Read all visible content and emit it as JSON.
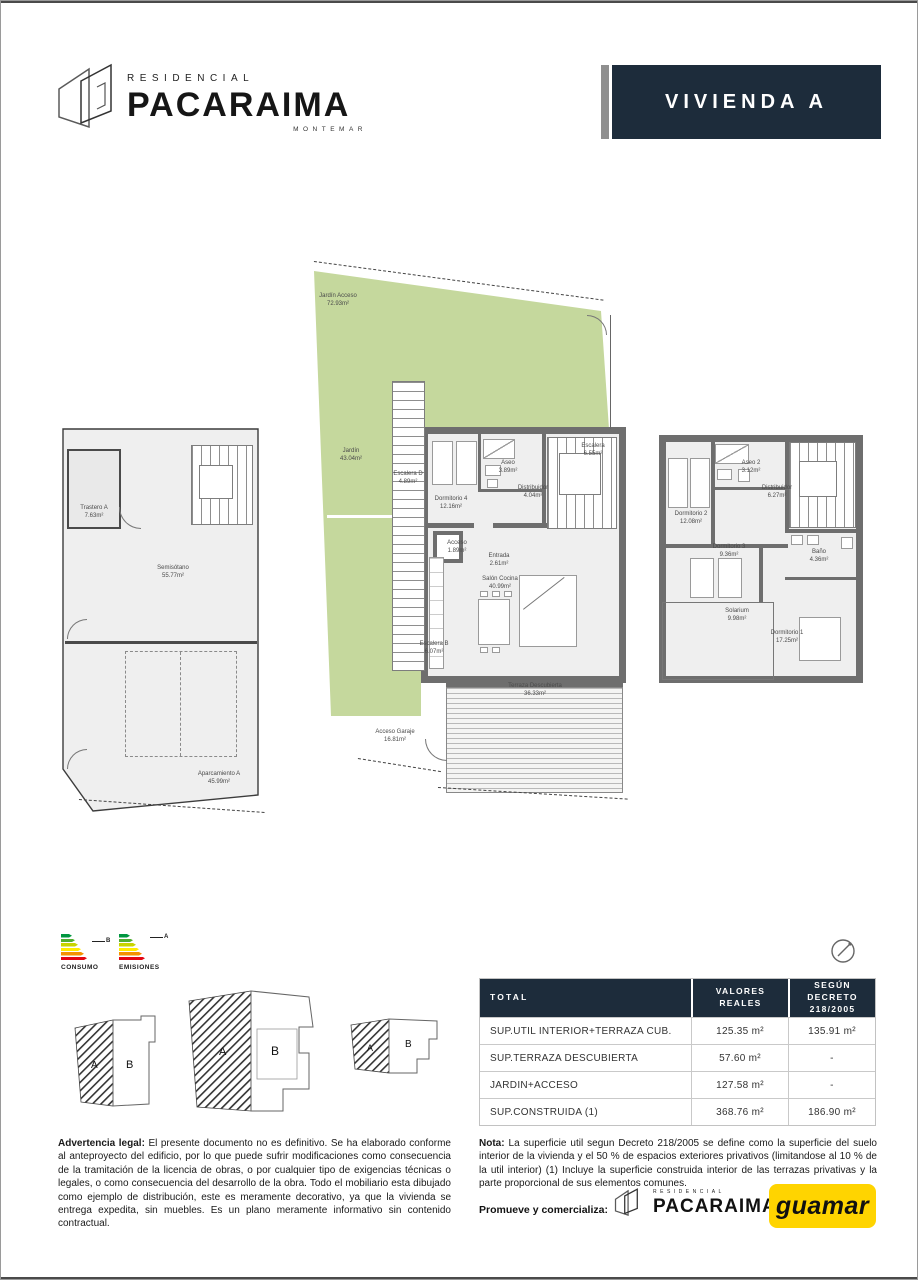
{
  "header": {
    "brand_top": "RESIDENCIAL",
    "brand_name": "PACARAIMA",
    "brand_sub": "MONTEMAR",
    "unit_title": "VIVIENDA A"
  },
  "plans": {
    "basement": {
      "rooms": [
        {
          "n": "Trastero A",
          "a": "7.63m²"
        },
        {
          "n": "Semisótano",
          "a": "55.77m²"
        },
        {
          "n": "Aparcamiento A",
          "a": "45.99m²"
        }
      ]
    },
    "ground": {
      "rooms": [
        {
          "n": "Jardín Acceso",
          "a": "72.93m²"
        },
        {
          "n": "Jardín",
          "a": "43.04m²"
        },
        {
          "n": "Escalera D",
          "a": "4.89m²"
        },
        {
          "n": "Dormitorio 4",
          "a": "12.16m²"
        },
        {
          "n": "Aseo",
          "a": "3.89m²"
        },
        {
          "n": "Distribuidor",
          "a": "4.04m²"
        },
        {
          "n": "Escalera",
          "a": "6.55m²"
        },
        {
          "n": "Acceso",
          "a": "1.89m²"
        },
        {
          "n": "Entrada",
          "a": "2.61m²"
        },
        {
          "n": "Salón Cocina",
          "a": "40.99m²"
        },
        {
          "n": "Escalera B",
          "a": "6.07m²"
        },
        {
          "n": "Terraza Descubierta",
          "a": "36.33m²"
        },
        {
          "n": "Acceso Garaje",
          "a": "16.81m²"
        }
      ]
    },
    "upper": {
      "rooms": [
        {
          "n": "Dormitorio 2",
          "a": "12.08m²"
        },
        {
          "n": "Aseo 2",
          "a": "3.12m²"
        },
        {
          "n": "Distribuidor",
          "a": "6.27m²"
        },
        {
          "n": "Baño",
          "a": "4.36m²"
        },
        {
          "n": "Dormitorio 3",
          "a": "9.36m²"
        },
        {
          "n": "Solarium",
          "a": "9.98m²"
        },
        {
          "n": "Dormitorio 1",
          "a": "17.25m²"
        }
      ]
    }
  },
  "energy": {
    "consumo_label": "CONSUMO",
    "consumo_rating": "B",
    "emisiones_label": "EMISIONES",
    "emisiones_rating": "A"
  },
  "keyplan": {
    "zone_a": "A",
    "zone_b": "B"
  },
  "table": {
    "headers": [
      "TOTAL",
      "VALORES REALES",
      "SEGÚN DECRETO 218/2005"
    ],
    "rows": [
      {
        "label": "SUP.UTIL INTERIOR+TERRAZA CUB.",
        "real": "125.35 m²",
        "decreto": "135.91 m²"
      },
      {
        "label": "SUP.TERRAZA DESCUBIERTA",
        "real": "57.60 m²",
        "decreto": "-"
      },
      {
        "label": "JARDIN+ACCESO",
        "real": "127.58 m²",
        "decreto": "-"
      },
      {
        "label": "SUP.CONSTRUIDA (1)",
        "real": "368.76 m²",
        "decreto": "186.90 m²"
      }
    ]
  },
  "legal": {
    "lead": "Advertencia legal:",
    "body": " El presente documento no es definitivo. Se ha elaborado conforme al anteproyecto del edificio, por lo que puede sufrir modificaciones como consecuencia de la tramitación de la licencia de obras, o por cualquier tipo de exigencias técnicas o legales, o como consecuencia del desarrollo de la obra. Todo el mobiliario esta dibujado como ejemplo de distribución, este es meramente decorativo, ya que la vivienda se entrega expedita, sin muebles. Es un plano meramente informativo sin contenido contractual."
  },
  "nota": {
    "lead": "Nota:",
    "body": " La superficie util segun Decreto 218/2005 se define como la superficie del suelo interior de la vivienda y el 50 % de espacios exteriores privativos (limitandose al 10 % de la util interior) (1) Incluye la superficie construida interior de las terrazas privativas y la parte proporcional de sus elementos comunes."
  },
  "footer": {
    "promueve_label": "Promueve y comercializa:",
    "guamar": "guamar"
  },
  "colors": {
    "navy": "#1d2c3b",
    "garden_green": "#c5d89d",
    "guamar_yellow": "#ffd400"
  }
}
